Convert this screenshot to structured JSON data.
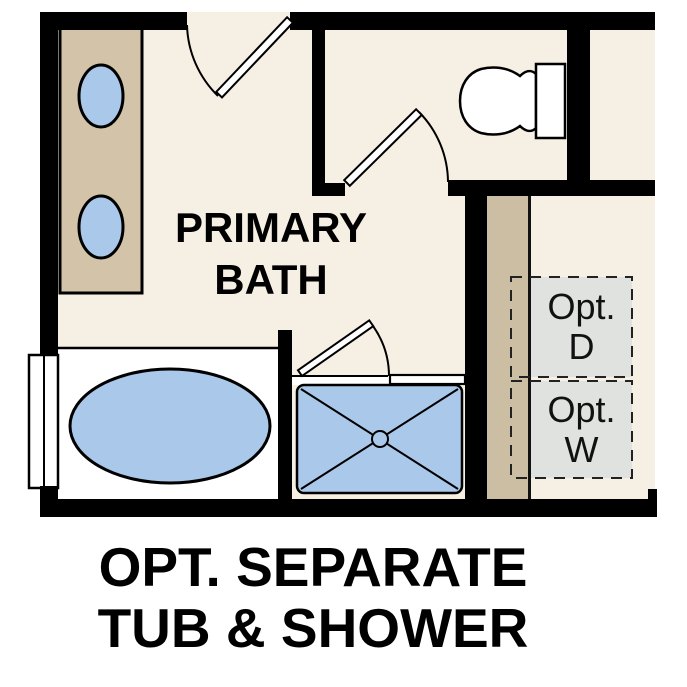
{
  "caption": {
    "line1": "OPT. SEPARATE",
    "line2": "TUB & SHOWER"
  },
  "floor_plan": {
    "room_label": {
      "line1": "PRIMARY",
      "line2": "BATH"
    },
    "optional_dryer": {
      "line1": "Opt.",
      "line2": "D"
    },
    "optional_washer": {
      "line1": "Opt.",
      "line2": "W"
    }
  },
  "fixtures": [
    "vanity-double-sink",
    "toilet",
    "soaking-tub",
    "walk-in-shower",
    "window",
    "entry-door",
    "water-closet-door",
    "shower-door",
    "optional-dryer-space",
    "optional-washer-space"
  ],
  "colors": {
    "floor": "#f6efe3",
    "wall": "#000000",
    "fixture_blue": "#aac8e9",
    "cabinet_tan": "#d2c3a9",
    "closet_tan": "#ccbea3",
    "optional_gray": "#e0e2df",
    "background": "#ffffff",
    "ink": "#000000"
  }
}
